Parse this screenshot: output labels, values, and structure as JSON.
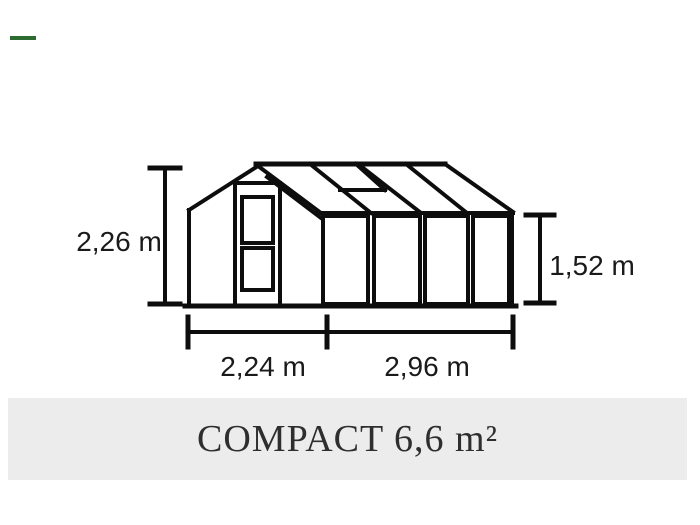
{
  "accent_dash": {
    "color": "#2e6b31"
  },
  "drawing": {
    "stroke_color": "#0d0d0d",
    "labels": {
      "total_height": "2,26 m",
      "eave_height": "1,52 m",
      "gable_width": "2,24 m",
      "side_length": "2,96 m"
    }
  },
  "title_bar": {
    "text": "COMPACT 6,6 m²",
    "background": "#ececec",
    "text_color": "#2e2e2e"
  }
}
